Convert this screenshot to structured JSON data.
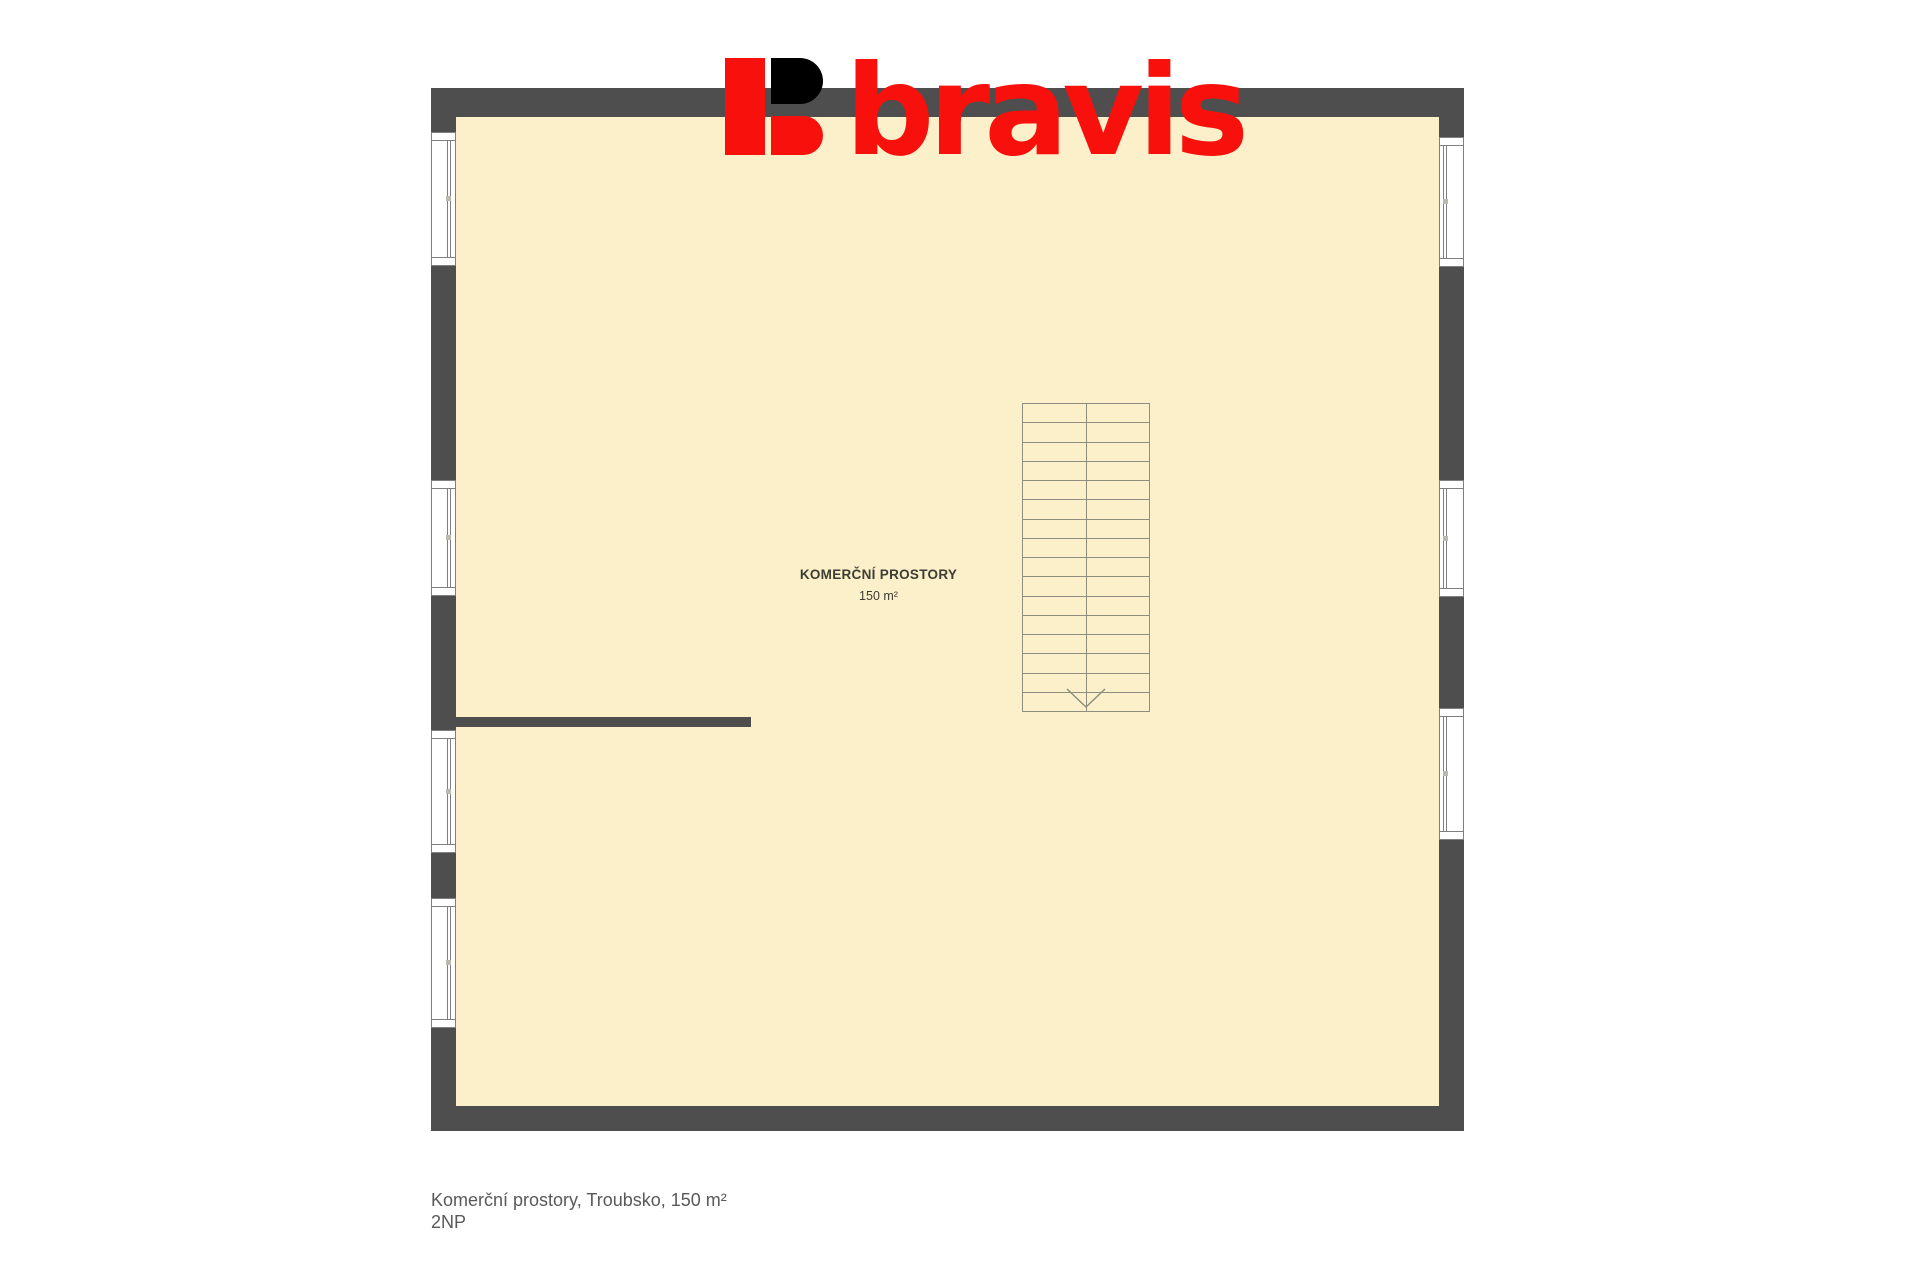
{
  "logo": {
    "wordmark": "bravis",
    "red": "#f7100c",
    "black": "#000000"
  },
  "floorplan": {
    "colors": {
      "wall": "#4e4e4e",
      "floor": "#fbf0c9",
      "stair_line": "#8e8e80",
      "window_border": "#7f7f7f",
      "window_handle": "#b9b9ae",
      "room_label": "#3d3d35"
    },
    "room": {
      "title": "KOMERČNÍ PROSTORY",
      "area": "150 m²"
    },
    "outer": {
      "x": 431,
      "y": 88,
      "w": 1033,
      "h": 1043
    },
    "floor": {
      "x": 456,
      "y": 117,
      "w": 983,
      "h": 989
    },
    "interior_wall": {
      "x": 447,
      "y": 717,
      "w": 304,
      "h": 10
    },
    "walls": {
      "left_x": 431,
      "right_x": 1439,
      "window_width": 25
    },
    "windows": [
      {
        "wall": "left",
        "y": 132,
        "h": 134
      },
      {
        "wall": "left",
        "y": 480,
        "h": 116
      },
      {
        "wall": "left",
        "y": 730,
        "h": 123
      },
      {
        "wall": "left",
        "y": 898,
        "h": 130
      },
      {
        "wall": "right",
        "y": 137,
        "h": 130
      },
      {
        "wall": "right",
        "y": 480,
        "h": 117
      },
      {
        "wall": "right",
        "y": 708,
        "h": 132
      }
    ],
    "stairs": {
      "x": 1022,
      "y": 403,
      "w": 128,
      "h": 309,
      "steps": 16
    }
  },
  "caption": {
    "line1": "Komerční prostory, Troubsko, 150 m²",
    "line2": "2NP"
  }
}
